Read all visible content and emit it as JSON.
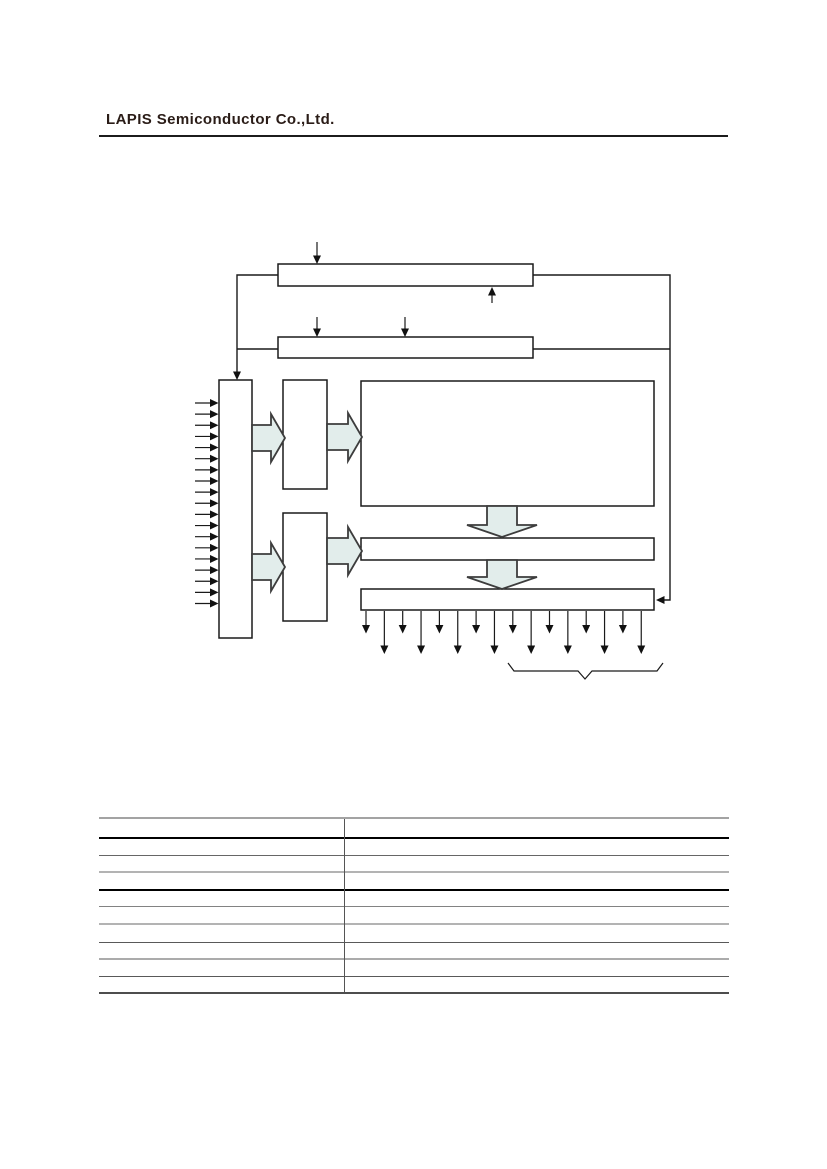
{
  "header": {
    "company": "LAPIS Semiconductor Co.,Ltd.",
    "brand_color": "#2a1c17"
  },
  "diagram": {
    "block_arrow_fill": "#e2edeb",
    "block_arrow_outline": "#3d3d3d",
    "line_color": "#1a1a1a",
    "input_arrow_count": 19,
    "output_arrow_count": 16
  },
  "table": {
    "column_count": 2,
    "rows": [
      [
        "",
        ""
      ],
      [
        "",
        ""
      ],
      [
        "",
        ""
      ],
      [
        "",
        ""
      ],
      [
        "",
        ""
      ],
      [
        "",
        ""
      ],
      [
        "",
        ""
      ],
      [
        "",
        ""
      ],
      [
        "",
        ""
      ],
      [
        "",
        ""
      ]
    ]
  }
}
